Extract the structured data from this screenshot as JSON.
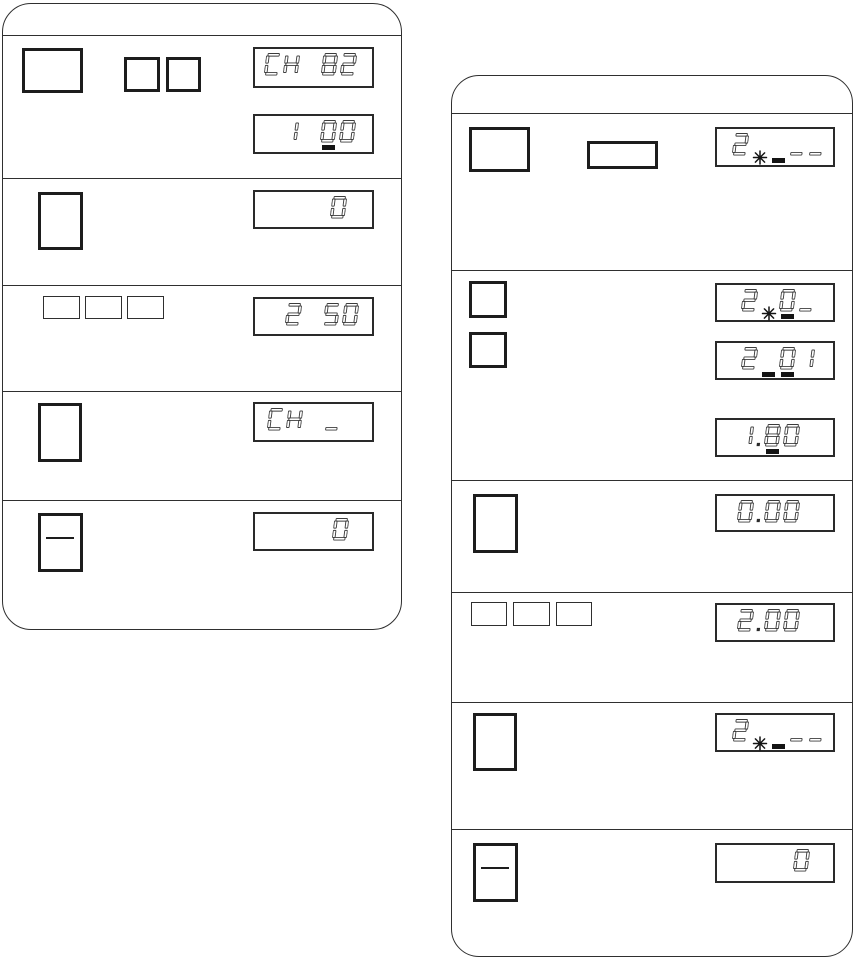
{
  "meta": {
    "bg_color": "#ffffff",
    "ink_color": "#1d1d1d",
    "line_color": "#2f2f2f",
    "segment_color": "#3c3c3c",
    "figure_type": "device keypad and LCD operation steps, two rounded step panels"
  },
  "panels": [
    {
      "name": "panel-left",
      "x": 2,
      "y": 3,
      "w": 400,
      "h": 627,
      "radius": 29,
      "header_h": 32,
      "separators": [
        174,
        281,
        387,
        496
      ]
    },
    {
      "name": "panel-right",
      "x": 451,
      "y": 75,
      "w": 402,
      "h": 882,
      "radius": 28,
      "header_h": 38,
      "separators": [
        194,
        404,
        516,
        626,
        753
      ]
    }
  ],
  "keys": [
    {
      "name": "key-large",
      "panel": "panel-left",
      "x": 22,
      "y": 48,
      "w": 61,
      "h": 45,
      "style": "bold"
    },
    {
      "name": "key-square",
      "panel": "panel-left",
      "x": 124,
      "y": 57,
      "w": 36,
      "h": 35,
      "style": "bold"
    },
    {
      "name": "key-square",
      "panel": "panel-left",
      "x": 166,
      "y": 57,
      "w": 35,
      "h": 35,
      "style": "bold"
    },
    {
      "name": "key-portrait",
      "panel": "panel-left",
      "x": 38,
      "y": 192,
      "w": 45,
      "h": 58,
      "style": "bold"
    },
    {
      "name": "key-flat",
      "panel": "panel-left",
      "x": 43,
      "y": 296,
      "w": 37,
      "h": 23,
      "style": "thin"
    },
    {
      "name": "key-flat",
      "panel": "panel-left",
      "x": 85,
      "y": 296,
      "w": 37,
      "h": 23,
      "style": "thin"
    },
    {
      "name": "key-flat",
      "panel": "panel-left",
      "x": 127,
      "y": 296,
      "w": 37,
      "h": 23,
      "style": "thin"
    },
    {
      "name": "key-portrait",
      "panel": "panel-left",
      "x": 38,
      "y": 403,
      "w": 44,
      "h": 59,
      "style": "bold"
    },
    {
      "name": "key-portrait-dash",
      "panel": "panel-left",
      "x": 38,
      "y": 513,
      "w": 45,
      "h": 59,
      "style": "bold",
      "dash": true
    },
    {
      "name": "key-large",
      "panel": "panel-right",
      "x": 469,
      "y": 127,
      "w": 61,
      "h": 45,
      "style": "bold"
    },
    {
      "name": "key-wide",
      "panel": "panel-right",
      "x": 587,
      "y": 141,
      "w": 71,
      "h": 28,
      "style": "bold"
    },
    {
      "name": "key-square",
      "panel": "panel-right",
      "x": 469,
      "y": 281,
      "w": 38,
      "h": 37,
      "style": "bold"
    },
    {
      "name": "key-square",
      "panel": "panel-right",
      "x": 469,
      "y": 332,
      "w": 38,
      "h": 36,
      "style": "bold"
    },
    {
      "name": "key-portrait",
      "panel": "panel-right",
      "x": 473,
      "y": 494,
      "w": 45,
      "h": 59,
      "style": "bold"
    },
    {
      "name": "key-flat",
      "panel": "panel-right",
      "x": 471,
      "y": 602,
      "w": 36,
      "h": 24,
      "style": "thin"
    },
    {
      "name": "key-flat",
      "panel": "panel-right",
      "x": 513,
      "y": 602,
      "w": 37,
      "h": 24,
      "style": "thin"
    },
    {
      "name": "key-flat",
      "panel": "panel-right",
      "x": 556,
      "y": 602,
      "w": 36,
      "h": 24,
      "style": "thin"
    },
    {
      "name": "key-portrait",
      "panel": "panel-right",
      "x": 473,
      "y": 713,
      "w": 44,
      "h": 58,
      "style": "bold"
    },
    {
      "name": "key-portrait-dash",
      "panel": "panel-right",
      "x": 473,
      "y": 843,
      "w": 45,
      "h": 59,
      "style": "bold",
      "dash": true
    }
  ],
  "displays": [
    {
      "name": "lcd-ch82",
      "panel": "panel-left",
      "text": "CH 82",
      "x": 253,
      "y": 47,
      "w": 121,
      "h": 41,
      "pad": 14,
      "cells": [
        {
          "c": "C"
        },
        {
          "c": "H"
        },
        {
          "c": " "
        },
        {
          "c": "8"
        },
        {
          "c": "2"
        }
      ]
    },
    {
      "name": "lcd-100",
      "panel": "panel-left",
      "text": "1 00 (cursor under first 0)",
      "x": 253,
      "y": 114,
      "w": 121,
      "h": 40,
      "pad": 15,
      "cells": [
        {
          "c": "1"
        },
        {
          "c": " "
        },
        {
          "c": "0",
          "m": "cursor"
        },
        {
          "c": "0"
        }
      ]
    },
    {
      "name": "lcd-zero",
      "panel": "panel-left",
      "text": "0",
      "x": 253,
      "y": 190,
      "w": 121,
      "h": 39,
      "pad": 24,
      "cells": [
        {
          "c": "0"
        }
      ]
    },
    {
      "name": "lcd-250",
      "panel": "panel-left",
      "text": "2 50",
      "x": 253,
      "y": 297,
      "w": 121,
      "h": 39,
      "pad": 12,
      "cells": [
        {
          "c": "2"
        },
        {
          "c": " "
        },
        {
          "c": "5"
        },
        {
          "c": "0"
        }
      ]
    },
    {
      "name": "lcd-ch-",
      "panel": "panel-left",
      "text": "CH _",
      "x": 253,
      "y": 402,
      "w": 121,
      "h": 40,
      "pad": 30,
      "cells": [
        {
          "c": "C"
        },
        {
          "c": "H"
        },
        {
          "c": " "
        },
        {
          "c": "_"
        }
      ]
    },
    {
      "name": "lcd-zero",
      "panel": "panel-left",
      "text": "0",
      "x": 253,
      "y": 512,
      "w": 121,
      "h": 39,
      "pad": 22,
      "cells": [
        {
          "c": "0"
        }
      ]
    },
    {
      "name": "lcd-2--",
      "panel": "panel-right",
      "text": "2 _ _ (flash + cursor)",
      "x": 715,
      "y": 127,
      "w": 120,
      "h": 40,
      "pad": 7,
      "cells": [
        {
          "c": "2"
        },
        {
          "c": " ",
          "m": "flash"
        },
        {
          "c": " ",
          "m": "cursor"
        },
        {
          "c": "_"
        },
        {
          "c": "_"
        }
      ]
    },
    {
      "name": "lcd-20-",
      "panel": "panel-right",
      "text": "2 0_ (flash, cursor under 0)",
      "x": 715,
      "y": 283,
      "w": 120,
      "h": 39,
      "pad": 17,
      "cells": [
        {
          "c": "2"
        },
        {
          "c": " ",
          "m": "flash"
        },
        {
          "c": "0",
          "m": "cursor"
        },
        {
          "c": "_"
        }
      ]
    },
    {
      "name": "lcd-201",
      "panel": "panel-right",
      "text": "2 01 (two cursor marks)",
      "x": 715,
      "y": 341,
      "w": 120,
      "h": 39,
      "pad": 17,
      "cells": [
        {
          "c": "2"
        },
        {
          "c": " ",
          "m": "cursor"
        },
        {
          "c": "0",
          "m": "cursor"
        },
        {
          "c": "1"
        }
      ]
    },
    {
      "name": "lcd-180",
      "panel": "panel-right",
      "text": "1.80 (cursor under 8)",
      "x": 715,
      "y": 418,
      "w": 120,
      "h": 39,
      "pad": 32,
      "cells": [
        {
          "c": "1"
        },
        {
          "c": ".",
          "dot": true
        },
        {
          "c": "8",
          "m": "cursor"
        },
        {
          "c": "0"
        }
      ]
    },
    {
      "name": "lcd-000",
      "panel": "panel-right",
      "text": "0.00",
      "x": 715,
      "y": 494,
      "w": 120,
      "h": 38,
      "pad": 32,
      "cells": [
        {
          "c": "0"
        },
        {
          "c": ".",
          "dot": true
        },
        {
          "c": "0"
        },
        {
          "c": "0"
        }
      ]
    },
    {
      "name": "lcd-200",
      "panel": "panel-right",
      "text": "2.00",
      "x": 715,
      "y": 603,
      "w": 120,
      "h": 39,
      "pad": 32,
      "cells": [
        {
          "c": "2"
        },
        {
          "c": ".",
          "dot": true
        },
        {
          "c": "0"
        },
        {
          "c": "0"
        }
      ]
    },
    {
      "name": "lcd-2--",
      "panel": "panel-right",
      "text": "2 _ _ (flash + cursor)",
      "x": 715,
      "y": 713,
      "w": 120,
      "h": 39,
      "pad": 7,
      "cells": [
        {
          "c": "2"
        },
        {
          "c": " ",
          "m": "flash"
        },
        {
          "c": " ",
          "m": "cursor"
        },
        {
          "c": "_"
        },
        {
          "c": "_"
        }
      ]
    },
    {
      "name": "lcd-zero",
      "panel": "panel-right",
      "text": "0",
      "x": 715,
      "y": 843,
      "w": 120,
      "h": 40,
      "pad": 22,
      "cells": [
        {
          "c": "0"
        }
      ]
    }
  ]
}
